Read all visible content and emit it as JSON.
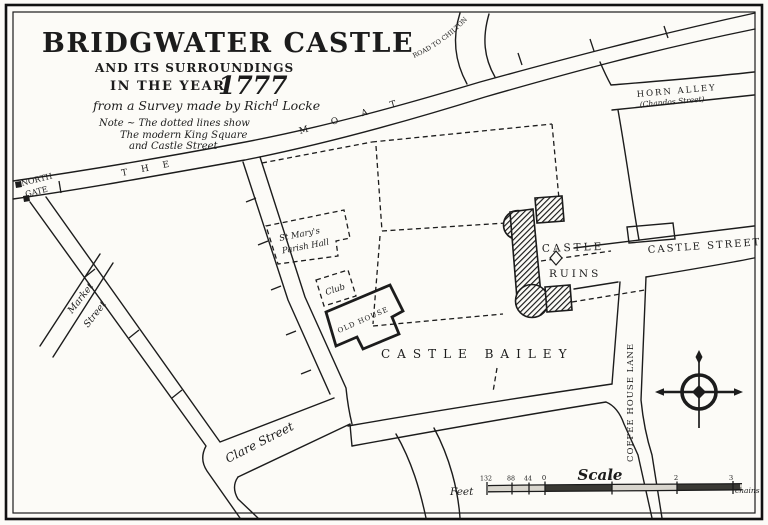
{
  "colors": {
    "ink": "#1c1c1c",
    "paper": "#fcfbf7"
  },
  "title_block": {
    "title": "BRIDGWATER CASTLE",
    "subtitle": "AND ITS SURROUNDINGS",
    "year_line": "IN THE YEAR",
    "year": "1777",
    "credit_pre": "from a Survey made by Rich",
    "credit_sup": "d",
    "credit_post": " Locke",
    "note_line1": "Note ~ The dotted lines show",
    "note_line2": "The modern King Square",
    "note_line3": "and Castle Street"
  },
  "streets": {
    "road_to_chilton": "ROAD TO CHILTON",
    "horn_alley": "HORN ALLEY",
    "horn_alley_modern": "(Chandos Street)",
    "north_gate_1": "NORTH",
    "north_gate_2": "GATE",
    "moat_word1": "THE",
    "moat_word2": "MOAT",
    "castle_street": "CASTLE STREET",
    "coffee_house_lane": "COFFEE HOUSE LANE",
    "castle_bailey": "CASTLE BAILEY",
    "market_street_1": "Market",
    "market_street_2": "Street",
    "clare_street": "Clare Street"
  },
  "places": {
    "st_marys_1": "St Mary's",
    "st_marys_2": "Parish Hall",
    "club": "Club",
    "old_house": "OLD HOUSE",
    "castle_ruins_1": "CASTLE",
    "castle_ruins_2": "RUINS"
  },
  "scale_bar": {
    "title": "Scale",
    "unit_left": "Feet",
    "ticks_feet": [
      "132",
      "88",
      "44",
      "0"
    ],
    "ticks_chains": [
      "1",
      "2",
      "3"
    ],
    "unit_right": "chains"
  }
}
